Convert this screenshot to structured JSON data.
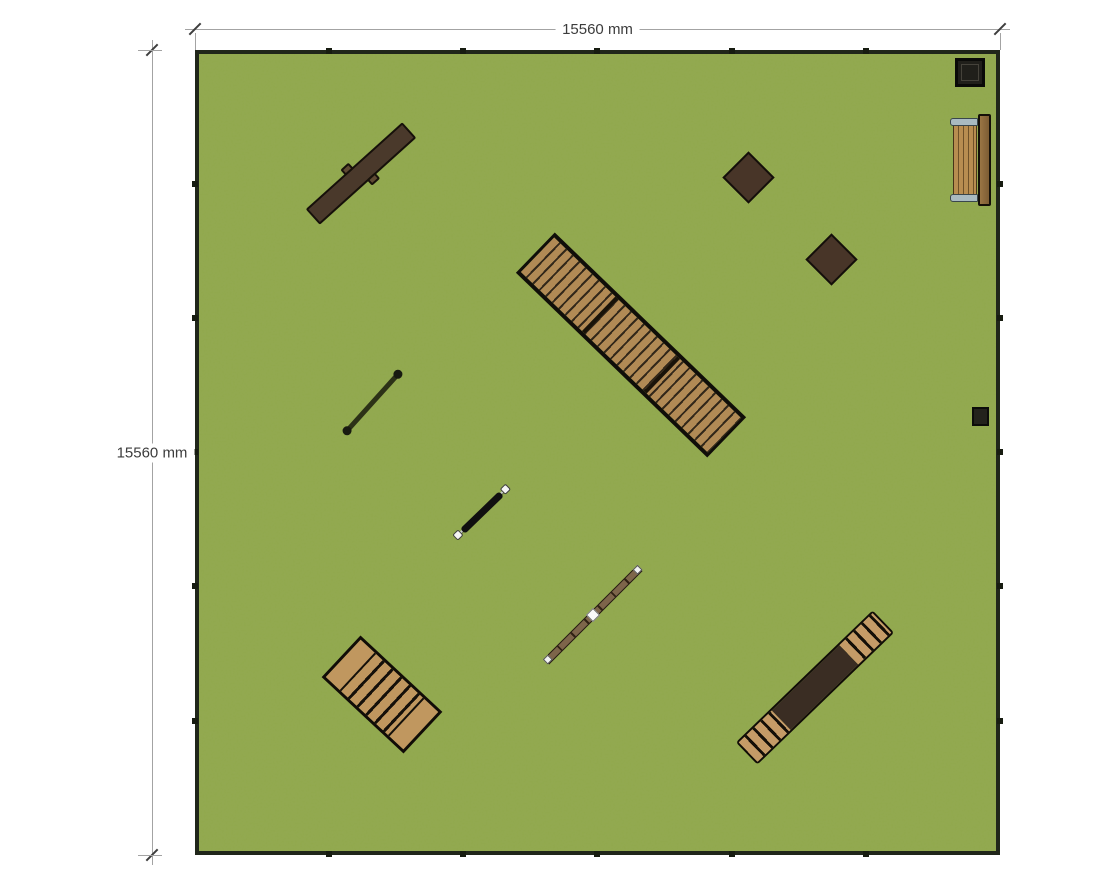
{
  "plan": {
    "title": "Square lawn site plan with play/park equipment",
    "dimension_top": {
      "label": "15560 mm"
    },
    "dimension_left": {
      "label": "15560 mm"
    },
    "ground": {
      "fill": "#90a84c",
      "border": "#20261a"
    },
    "accent_colors": {
      "dark_wood": "#4a392b",
      "plank_wood": "#b18a55",
      "light_wood": "#c0975f",
      "metal_gray": "#a9bac1",
      "dim_text": "#3c3c3c"
    },
    "objects": [
      {
        "id": "balance-beam-dark",
        "desc": "dark wooden balance beam with two side supports",
        "color": "#4a392b"
      },
      {
        "id": "square-platform-1",
        "desc": "rotated square wooden platform",
        "color": "#483528"
      },
      {
        "id": "square-platform-2",
        "desc": "rotated square wooden platform",
        "color": "#483528"
      },
      {
        "id": "square-bin",
        "desc": "framed square bin at top-right corner",
        "color": "#201f1a"
      },
      {
        "id": "park-bench",
        "desc": "slatted bench with metal armrests and backrest",
        "color": "#b88d50"
      },
      {
        "id": "plank-walkway",
        "desc": "long diagonal boardwalk of three slatted sections with side rails",
        "color": "#b18a55"
      },
      {
        "id": "thin-pole",
        "desc": "thin dark low beam with round ends",
        "color": "#2c3117"
      },
      {
        "id": "steel-balance-bar",
        "desc": "black bar with white end caps",
        "color": "#101010"
      },
      {
        "id": "seesaw-beam",
        "desc": "wooden beam with white end caps and center pivot",
        "color": "#7d654a"
      },
      {
        "id": "stepped-platform",
        "desc": "rectangular wooden stair platform",
        "color": "#c0975f"
      },
      {
        "id": "step-ramp",
        "desc": "ramp with steps at both ends and dark middle",
        "color": "#c59b67"
      },
      {
        "id": "small-box",
        "desc": "small dark box near right edge",
        "color": "#23221c"
      }
    ],
    "fence": {
      "post_color": "#171c11",
      "posts_per_side": 5
    }
  }
}
